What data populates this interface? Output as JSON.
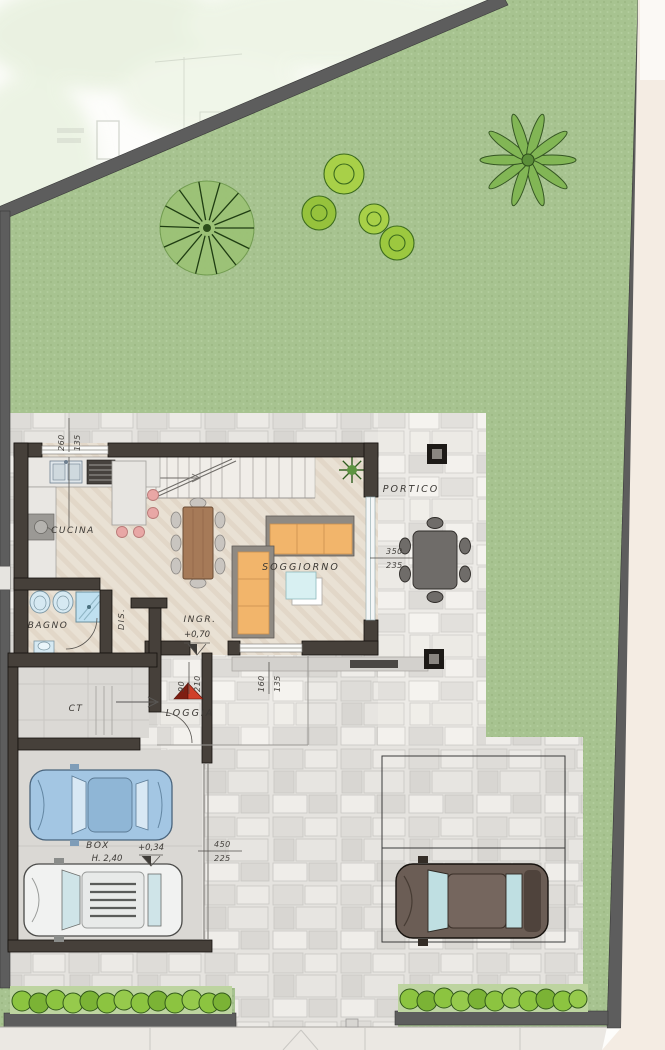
{
  "plan": {
    "rooms": {
      "cucina": "CUCINA",
      "bagno": "BAGNO",
      "dis": "DIS.",
      "ingresso": "INGR.",
      "soggiorno": "SOGGIORNO",
      "portico": "PORTICO",
      "loggia": "LOGGIA",
      "ct": "CT",
      "box": "BOX"
    },
    "notes": {
      "box_height": "H. 2,40"
    },
    "levels": {
      "ingresso": "+0,70",
      "box": "+0,34"
    },
    "dimensions": {
      "kitchen_window": {
        "width": "260",
        "height": "135"
      },
      "entry_door": {
        "width": "90",
        "height": "210"
      },
      "living_window": {
        "width": "160",
        "height": "135"
      },
      "portico_opening": {
        "width": "350",
        "height": "235"
      },
      "garage_front": {
        "width": "450",
        "height": "225"
      }
    },
    "colors": {
      "grass": "#a7c390",
      "wall": "#46403a",
      "boundary": "#5d5d5d",
      "paving": "#e5e3df",
      "wood_floor": "#e9e1d4",
      "sofa": "#f2b56b",
      "accent_red": "#c23a27",
      "hedge": "#8cc440",
      "water_blue": "#bfe0f0"
    }
  }
}
